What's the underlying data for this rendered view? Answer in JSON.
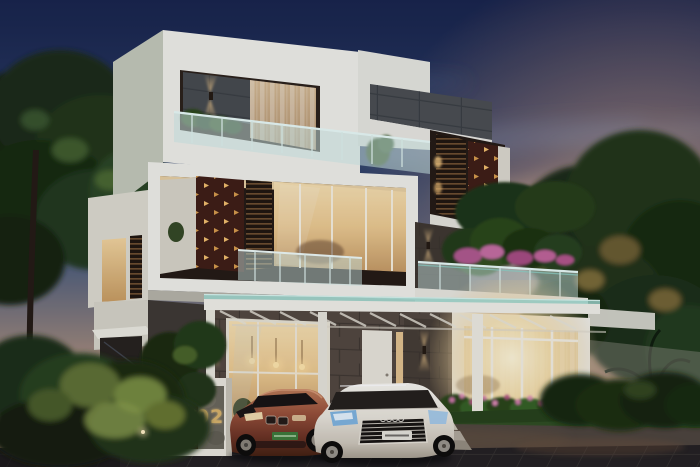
{
  "meta": {
    "type_label": "photorealistic dusk rendering of a modern three-storey villa",
    "visible_text": [
      "02"
    ]
  },
  "gate": {
    "house_number": "02"
  },
  "vehicles": {
    "left_car": "bronze sedan",
    "right_car": "white sedan"
  },
  "elements": [
    "three-storey white modern villa",
    "perforated corten steel screens with glowing cutouts",
    "horizontal timber louver screens",
    "glass balustrade balconies with planters",
    "carport pergola with glass roof and two parked sedans",
    "glazed sunroom with warm interior light and sheer curtains",
    "terrace gardens with pink flowering shrubs",
    "white compound wall and number pillar 02",
    "dusk sky with navy top and orange sunset clouds",
    "dense trees on both sides"
  ],
  "palette": {
    "sky_top": "#18234a",
    "sky_sunset": "#e7b68c",
    "white_wall": "#f0efe8",
    "shaded_wall": "#c4c8b8",
    "tile_gray": "#4b4e50",
    "stone_brown": "#53473d",
    "stone_dark": "#463c32",
    "corten": "#3f1d13",
    "corten_glow": "#f2bd6a",
    "louver_warm": "#b9854d",
    "interior_warm": "#ecc98e",
    "glass_teal": "#cfe9e4",
    "foliage_dark": "#1b2c12",
    "foliage_light": "#6f8038",
    "flower_pink": "#c96f9f",
    "grass": "#2f4d20",
    "apron": "#4e443b",
    "road": "#242020",
    "car_bronze": "#9a5138",
    "car_white": "#e9e4d9",
    "plate_green": "#3d7a38",
    "concrete": "#6b6659",
    "gold_number": "#d8b269"
  }
}
